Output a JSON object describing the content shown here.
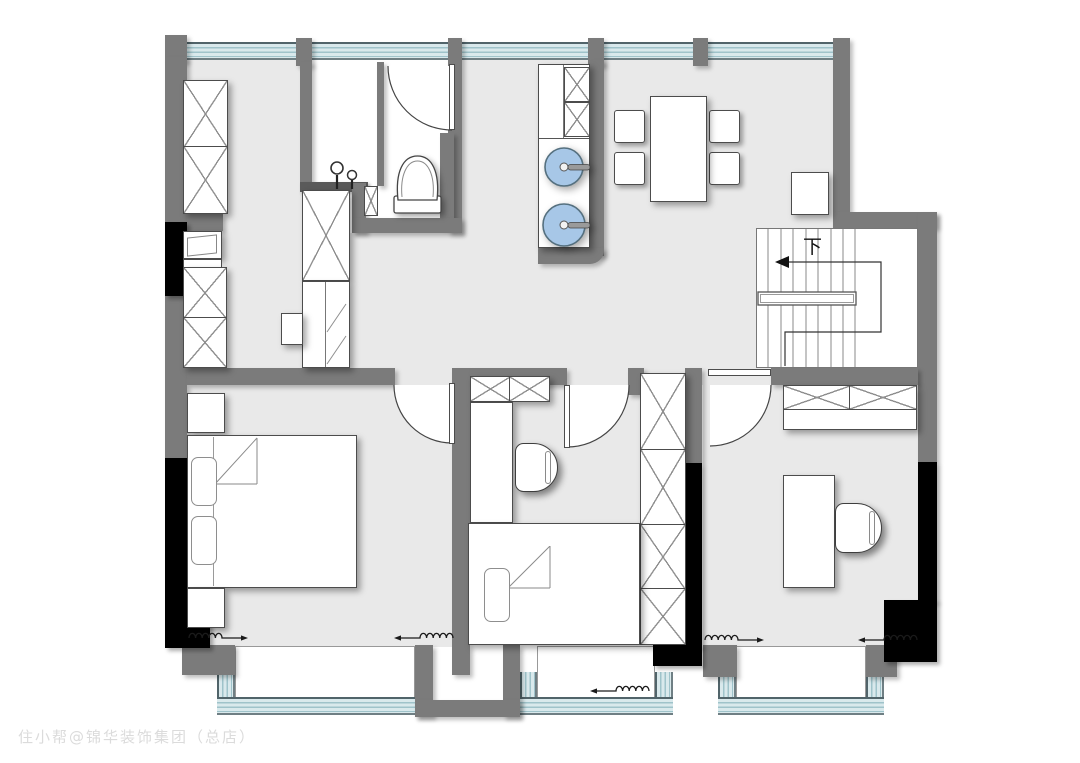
{
  "watermark": {
    "text": "住小帮@锦华装饰集团（总店）"
  },
  "stairs": {
    "down_label": "下"
  },
  "colors": {
    "wall": "#7b7b7b",
    "column": "#000000",
    "floor": "#e9e9e9",
    "glass": "#d9e9ec",
    "glass_line": "#9fc3ca",
    "basin": "#a7c7e7",
    "furniture_line": "#4c4c4c"
  }
}
